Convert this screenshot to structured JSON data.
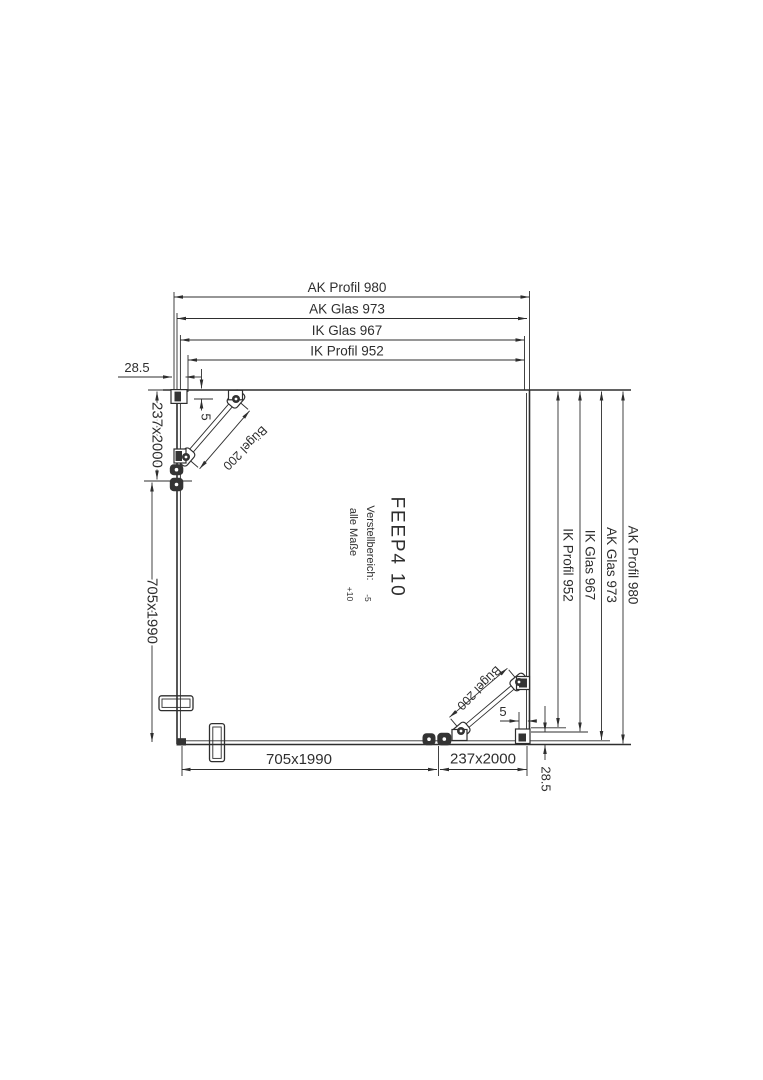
{
  "page": {
    "background": "#ffffff",
    "ink": "#2e2e2e"
  },
  "drawing": {
    "model": "FEEP4 10",
    "adjustment_note": {
      "line1": "Verstellbereich:",
      "line1_tol": "-5",
      "line2": "alle Maße",
      "line2_tol": "+10"
    },
    "dimensions": {
      "horizontal_top": [
        "AK Profil 980",
        "AK Glas 973",
        "IK Glas 967",
        "IK Profil 952"
      ],
      "vertical_right": [
        "AK Profil 980",
        "AK Glas 973",
        "IK Glas 967",
        "IK Profil 952"
      ],
      "offset_top_left": "28.5",
      "offset_bottom_right": "28.5",
      "gap_top_left": "5",
      "gap_bottom_right": "5",
      "panel_left_upper": "237x2000",
      "panel_left_lower": "705x1990",
      "panel_bottom_left": "705x1990",
      "panel_bottom_right": "237x2000",
      "brace_top_left": "Bügel 200",
      "brace_bottom_right": "Bügel 200"
    }
  }
}
